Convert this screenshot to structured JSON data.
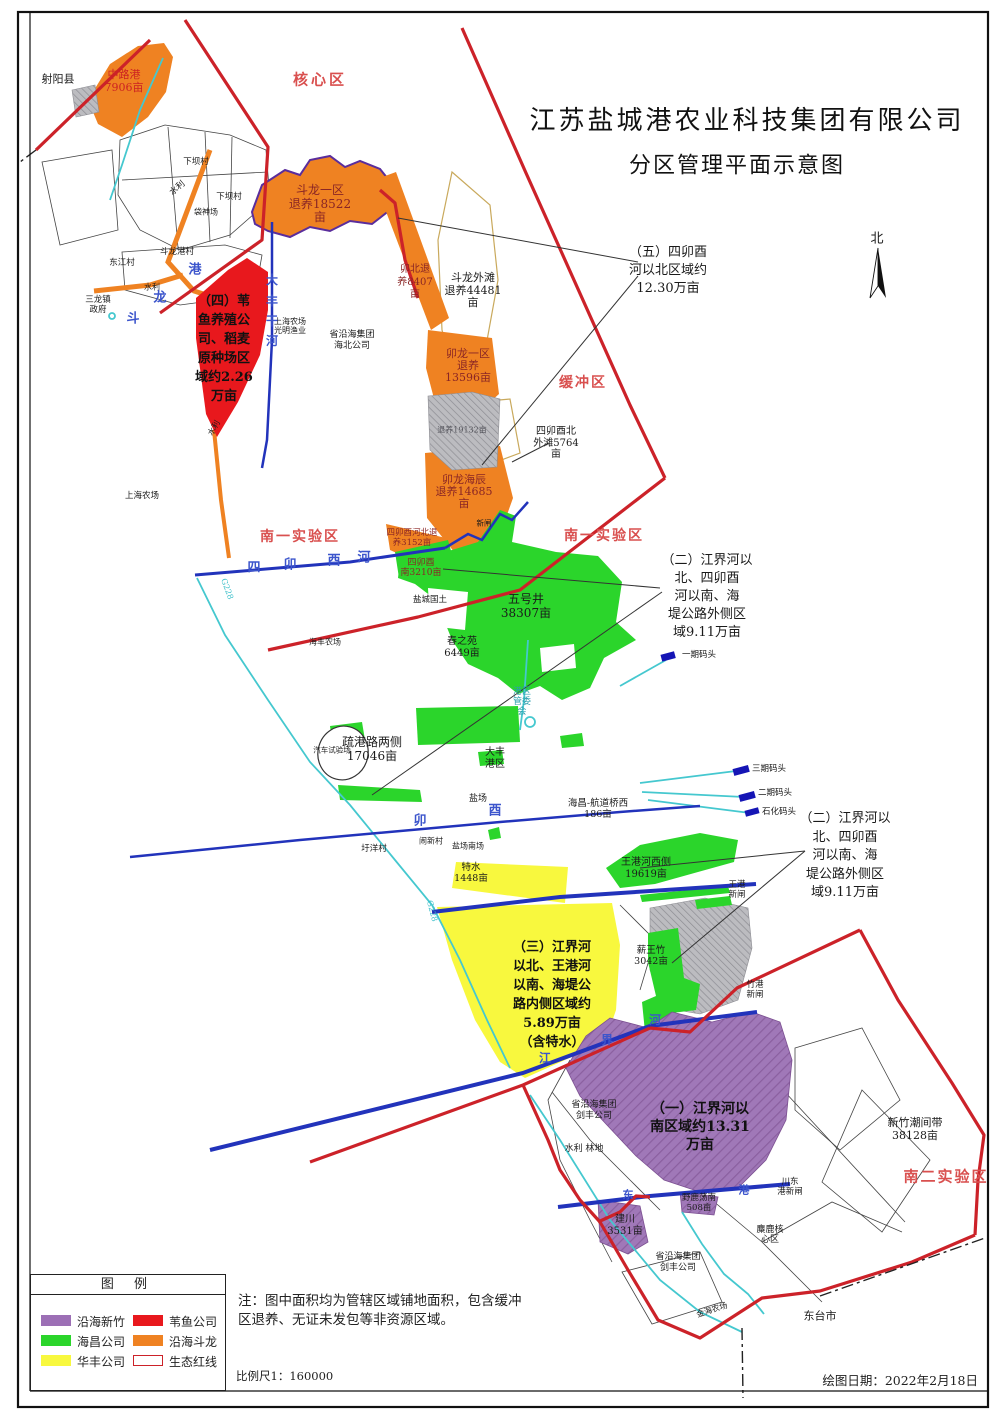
{
  "colors": {
    "purple": "#9c6fb5",
    "red": "#e8181d",
    "green": "#2bd52b",
    "orange": "#ef8222",
    "yellow": "#f8f83e",
    "eco_line": "#cc2229"
  },
  "title": {
    "line1": "江苏盐城港农业科技集团有限公司",
    "line2": "分区管理平面示意图"
  },
  "compass_label": "北",
  "zones": {
    "core": "核心区",
    "buffer": "缓冲区",
    "south1_left": "南一实验区",
    "south1_right": "南一实验区",
    "south2": "南二实验区"
  },
  "annotations": {
    "a5": "（五）四卯酉\n河以北区域约\n12.30万亩",
    "a2a": "（二）江界河以\n北、四卯酉\n河以南、海\n堤公路外侧区\n域9.11万亩",
    "a2b": "（二）江界河以\n北、四卯酉\n河以南、海\n堤公路外侧区\n域9.11万亩",
    "a4": "（四）苇\n鱼养殖公\n司、稻麦\n原种场区\n域约2.26\n万亩",
    "a3": "（三）江界河\n以北、王港河\n以南、海堤公\n路内侧区域约\n5.89万亩\n（含特水）",
    "a1": "（一）江界河以\n南区域约13.31\n万亩",
    "waitan": "四卯酉北\n外滩5764\n亩",
    "chaojian": "新竹潮间带\n38128亩"
  },
  "regions": {
    "zhonglugang": "中路港\n7906亩",
    "doulong1": "斗龙一区\n退养18522\n亩",
    "maobei": "卯北退\n养8407\n亩",
    "doulongwaitan": "斗龙外滩\n退养44481\n亩",
    "maolong1": "卯龙一区\n退养\n13596亩",
    "tuiyang19132": "退养19132亩",
    "maolonghaichen": "卯龙海辰\n退养14685\n亩",
    "sihe_bei": "四卯酉河北退\n养3152亩",
    "sihe_nan": "四卯酉\n南3210亩",
    "wuhaojing": "五号井\n38307亩",
    "chunzhiyuan": "春之苑\n6449亩",
    "shuganglu": "疏港路两侧\n17046亩",
    "teshui": "特水\n1448亩",
    "wangganghe": "王港河西侧\n19619亩",
    "xinwangzhu": "薪王竹\n3042亩",
    "haichang": "海昌-航道桥西\n186亩",
    "jianchuan": "建川\n3531亩",
    "yeludang": "野鹿荡南\n508亩"
  },
  "places": {
    "sheyang": "射阳县",
    "xiaba1": "下坝村",
    "xiaba2": "下坝村",
    "shuili1": "水利",
    "shuili2": "水利",
    "shuili3": "水利",
    "daishenchang": "袋神场",
    "doulonggangcun": "斗龙港村",
    "dongjiangcun": "东江村",
    "sanlongzhen": "三龙镇\n政府",
    "shanghai1": "上海农场\n光明渔业",
    "haibei": "省沿海集团\n海北公司",
    "haifeng": "海丰农场",
    "shanghai2": "上海农场",
    "yancheng_guotu": "盐城国土",
    "gangqu": "港区\n管委\n会",
    "dafenggang": "大丰\n港区",
    "qiche": "汽车试验场",
    "yanchang": "盐场",
    "yanchangnan": "盐场南场",
    "weiyangcun": "圩洋村",
    "naoxincun": "闹新村",
    "xinzha": "新闸",
    "wanggangxinzha": "王港\n新闸",
    "zhugangxinzha": "竹港\n新闸",
    "chuandongxinzha": "川东\n港新闸",
    "milu": "麋鹿核\n心区",
    "jianfeng1": "省沿海集团\n剑丰公司",
    "shuililindi": "水利 林地",
    "jianfeng2": "省沿海集团\n剑丰公司",
    "dongtai": "东台市",
    "jinhai": "金海农场"
  },
  "rivers": {
    "simaoyou": [
      "四",
      "卯",
      "酉",
      "河"
    ],
    "maoyou_mid": [
      "卯",
      "酉"
    ],
    "jiangjiehe": [
      "江",
      "界",
      "河"
    ],
    "doulonggang": [
      "斗",
      "龙",
      "港"
    ],
    "dafengganhe": [
      "大",
      "丰",
      "干",
      "河"
    ],
    "chuandonggang": [
      "东",
      "港"
    ]
  },
  "docks": {
    "d1": "一期码头",
    "d3": "三期码头",
    "d2": "二期码头",
    "dsh": "石化码头"
  },
  "roads": {
    "g228a": "G228",
    "g228b": "G228"
  },
  "legend": {
    "header": "图  例",
    "items": [
      {
        "label": "沿海新竹",
        "key": "purple"
      },
      {
        "label": "苇鱼公司",
        "key": "red"
      },
      {
        "label": "海昌公司",
        "key": "green"
      },
      {
        "label": "沿海斗龙",
        "key": "orange"
      },
      {
        "label": "华丰公司",
        "key": "yellow"
      },
      {
        "label": "生态红线",
        "key": "eco"
      }
    ],
    "scale": "比例尺1：160000"
  },
  "note": "注：图中面积均为管辖区域铺地面积，包含缓冲\n区退养、无证未发包等非资源区域。",
  "date_label": "绘图日期：2022年2月18日"
}
